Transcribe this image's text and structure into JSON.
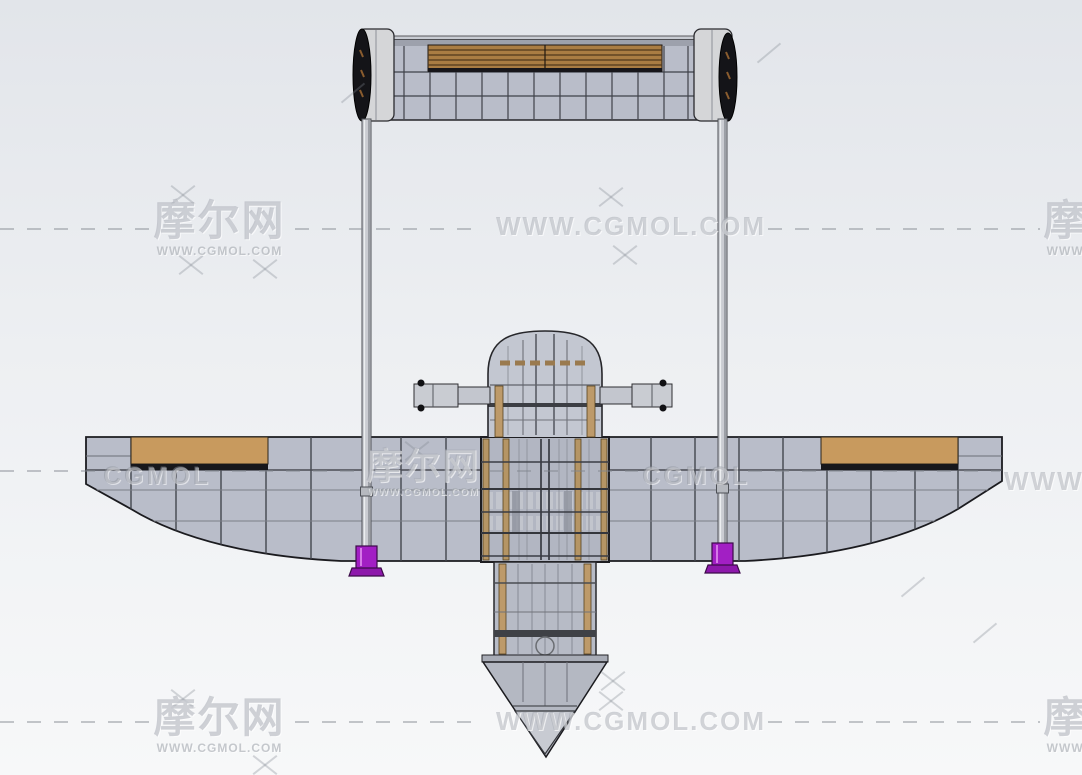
{
  "watermarks": {
    "brand": "摩尔网",
    "site_url": "WWW.CGMOL.COM",
    "site_short": "CGMOL"
  },
  "colors": {
    "background_top": "#e2e5ea",
    "background_bottom": "#f7f8f9",
    "panel_gray": "#b9bdc9",
    "end_cap_gray": "#d5d6d8",
    "wing_wood_tan": "#c89a5e",
    "slat_brown": "#aa7d43",
    "frame_post_tan": "#bd9a6a",
    "strut_fitting_purple": "#a21fc4",
    "outline_dark": "#222226",
    "watermark_gray": "#9aa0a8"
  }
}
